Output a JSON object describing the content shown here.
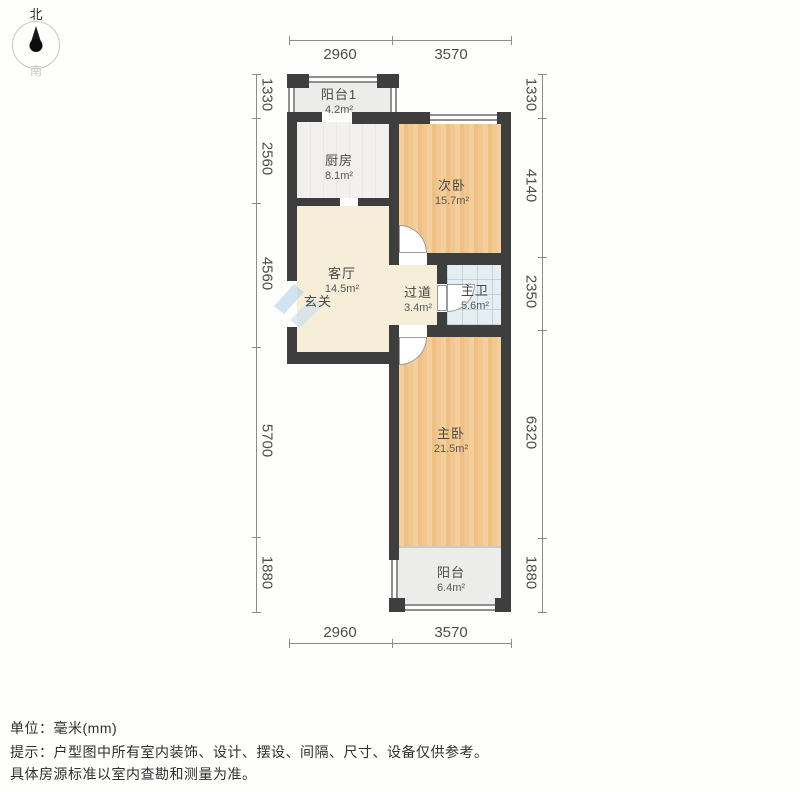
{
  "compass": {
    "north_label": "北",
    "south_label": "南"
  },
  "dimensions": {
    "unit": "mm",
    "top": [
      "2960",
      "3570"
    ],
    "bottom": [
      "2960",
      "3570"
    ],
    "left": [
      "1330",
      "2560",
      "4560",
      "5700",
      "1880"
    ],
    "right": [
      "1330",
      "4140",
      "2350",
      "6320",
      "1880"
    ]
  },
  "rooms": {
    "balcony1": {
      "name": "阳台1",
      "area": "4.2m²"
    },
    "kitchen": {
      "name": "厨房",
      "area": "8.1m²"
    },
    "bedroom2": {
      "name": "次卧",
      "area": "15.7m²"
    },
    "living": {
      "name": "客厅",
      "area": "14.5m²"
    },
    "foyer": {
      "name": "玄关"
    },
    "hallway": {
      "name": "过道",
      "area": "3.4m²"
    },
    "bathroom": {
      "name": "主卫",
      "area": "5.6m²"
    },
    "bedroom1": {
      "name": "主卧",
      "area": "21.5m²"
    },
    "balcony2": {
      "name": "阳台",
      "area": "6.4m²"
    }
  },
  "footer": {
    "unit_line": "单位：毫米(mm)",
    "note_line1": "提示：户型图中所有室内装饰、设计、摆设、间隔、尺寸、设备仅供参考。",
    "note_line2": "具体房源标准以室内查勘和测量为准。"
  },
  "colors": {
    "wall": "#3e3e3e",
    "window_line": "#8f8f8f",
    "wood_floor": "#f1c78e",
    "living_floor": "#f7eed9",
    "kitchen_floor": "#f1f0ee",
    "balcony_floor": "#ececea",
    "bath_floor": "#e4eef3",
    "dimension_text": "#4d4d4d",
    "watermark_blue": "#aecfe8"
  }
}
